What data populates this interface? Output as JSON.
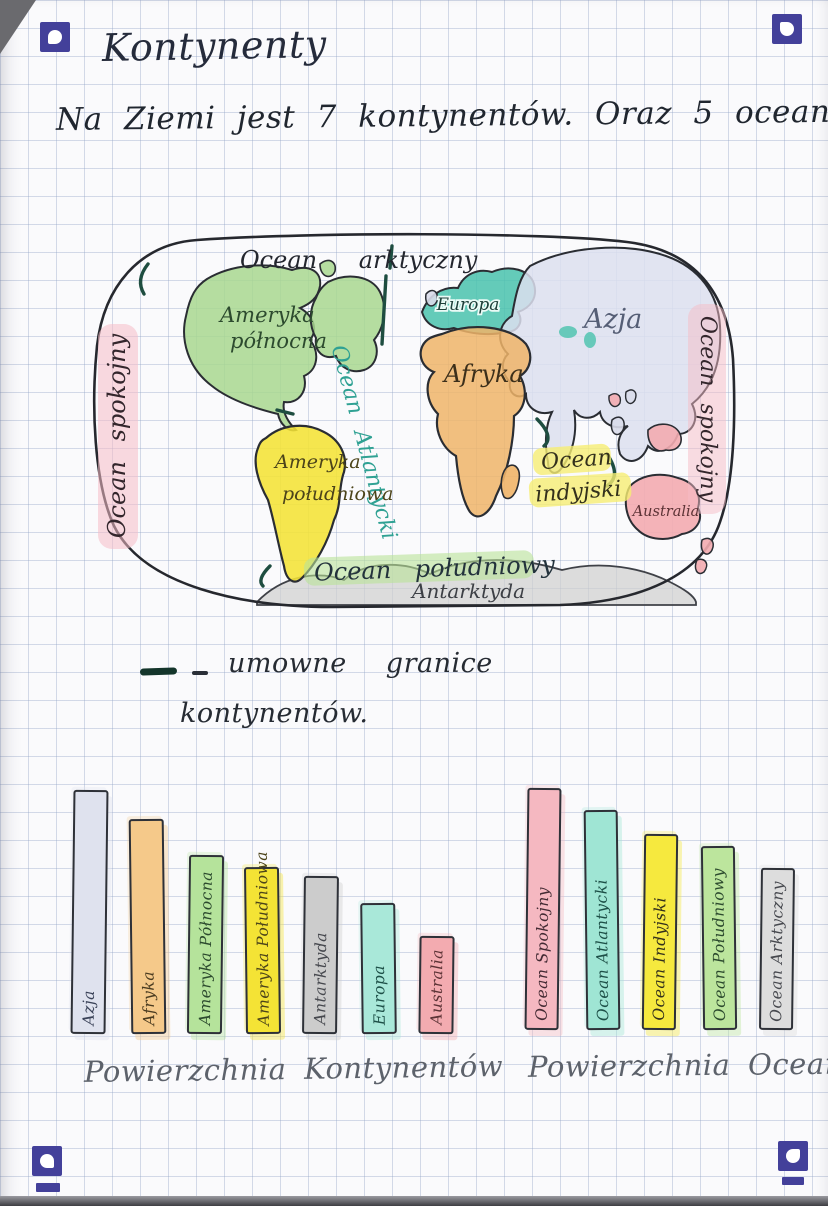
{
  "page": {
    "title": "Kontynenty",
    "intro": "Na Ziemi jest 7 kontynentów. Oraz 5 oceanów.",
    "legend": {
      "line1": "umowne granice",
      "line2": "kontynentów."
    },
    "corner_markers": {
      "count": 4,
      "color": "#43409a"
    }
  },
  "map": {
    "ocean_labels": {
      "arctic": "Ocean arktyczny",
      "pacific_left": "Ocean spokojny",
      "pacific_right": "Ocean spokojny",
      "atlantic": "Ocean Atlantycki",
      "indian_line1": "Ocean",
      "indian_line2": "indyjski",
      "southern": "Ocean południowy"
    },
    "continent_labels": {
      "north_america_line1": "Ameryka",
      "north_america_line2": "północna",
      "south_america_line1": "Ameryka",
      "south_america_line2": "południowa",
      "europe": "Europa",
      "asia": "Azja",
      "africa": "Afryka",
      "australia": "Australia",
      "antarctica": "Antarktyda"
    },
    "colors": {
      "north_america": "#a8d78f",
      "europe": "#49c2ad",
      "asia": "#dcdfee",
      "africa": "#efb468",
      "south_america": "#f4e335",
      "australia": "#f3abb0",
      "antarctica": "#cfcfcf",
      "pacific_highlight": "#f5bcc6",
      "indian_highlight": "#f6ee73",
      "southern_highlight": "#b9e398",
      "atlantic_ink": "#2fa193"
    }
  },
  "chart_data": [
    {
      "type": "bar",
      "title": "Powierzchnia Kontynentów",
      "categories": [
        "Azja",
        "Afryka",
        "Ameryka Północna",
        "Ameryka Południowa",
        "Antarktyda",
        "Europa",
        "Australia"
      ],
      "values_relative": [
        100,
        88,
        73,
        68,
        64,
        53,
        39
      ],
      "value_note": "relative bar heights; no numeric axis shown in drawing",
      "bar_colors": [
        "#dfe2ee",
        "#f5c98a",
        "#b5e39b",
        "#f4e335",
        "#cccccc",
        "#a9e8d9",
        "#f3abb0"
      ],
      "label_colors": [
        "#3a4258",
        "#4a3b20",
        "#2c4a2e",
        "#4c441a",
        "#46484e",
        "#1d4f47",
        "#5c3336"
      ],
      "xlabel": "",
      "ylabel": ""
    },
    {
      "type": "bar",
      "title": "Powierzchnia Oceanów",
      "categories": [
        "Ocean Spokojny",
        "Ocean Atlantycki",
        "Ocean Indyjski",
        "Ocean Południowy",
        "Ocean Arktyczny"
      ],
      "values_relative": [
        99,
        90,
        80,
        75,
        66
      ],
      "value_note": "relative bar heights; no numeric axis shown in drawing",
      "bar_colors": [
        "#f5b8c1",
        "#9fe5d4",
        "#f6e93e",
        "#bce59d",
        "#dddddd"
      ],
      "label_colors": [
        "#432a33",
        "#1d4f47",
        "#33301c",
        "#2c4a2e",
        "#46484e"
      ],
      "xlabel": "",
      "ylabel": ""
    }
  ]
}
